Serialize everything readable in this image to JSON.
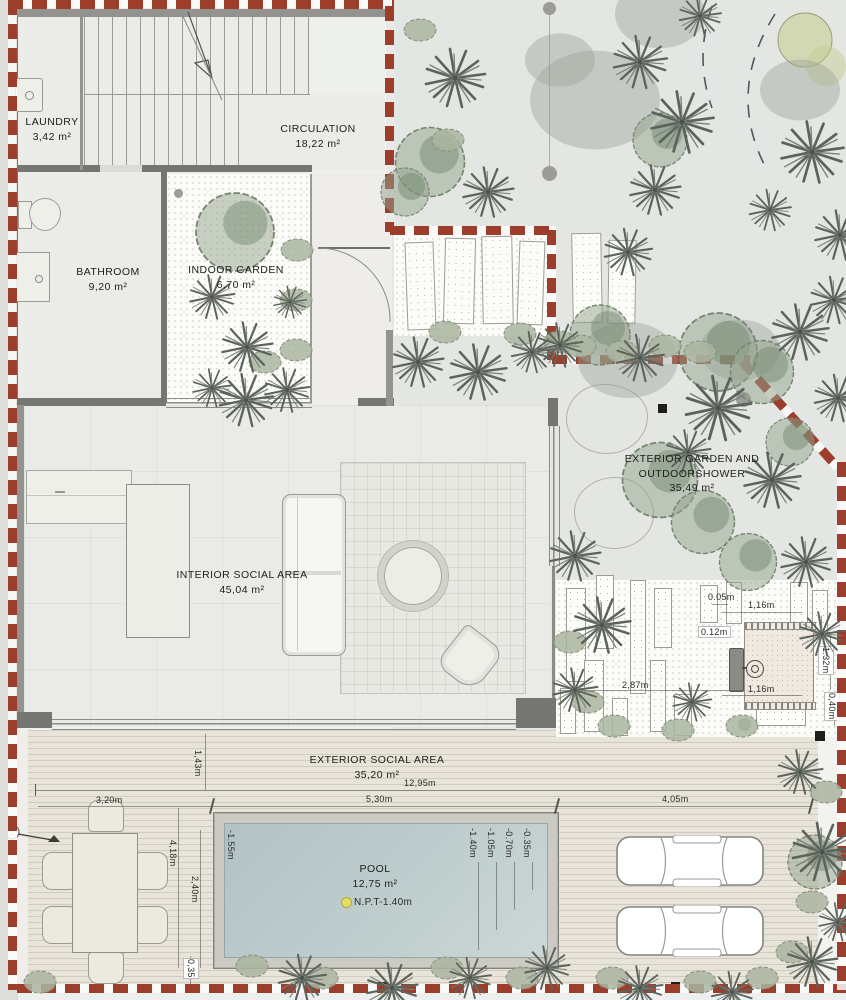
{
  "plan": {
    "rooms": {
      "laundry": {
        "name": "LAUNDRY",
        "area": "3,42 m²"
      },
      "circulation": {
        "name": "CIRCULATION",
        "area": "18,22 m²"
      },
      "bathroom": {
        "name": "BATHROOM",
        "area": "9,20 m²"
      },
      "indoor_garden": {
        "name": "INDOOR GARDEN",
        "area": "6,70 m²"
      },
      "interior_social": {
        "name": "INTERIOR SOCIAL AREA",
        "area": "45,04 m²"
      },
      "exterior_garden": {
        "name_line1": "EXTERIOR GARDEN AND",
        "name_line2": "OUTDOORSHOWER",
        "area": "35,49 m²"
      },
      "exterior_social": {
        "name": "EXTERIOR SOCIAL AREA",
        "area": "35,20 m²"
      },
      "pool": {
        "name": "POOL",
        "area": "12,75 m²",
        "npt_level": "N.P.T-1.40m"
      }
    },
    "dimensions": {
      "overall_width": "12,95m",
      "pool_width": "5,30m",
      "driveway_width": "4,05m",
      "table_zone_width": "3,20m",
      "deck_offset": "1,43m",
      "deck_length": "4,18m",
      "pool_band": "2,40m",
      "edge_strip": "0,35",
      "shower_gap": "0.05m",
      "shower_pad_top": "1,16m",
      "shower_fixture": "0.12m",
      "gravel_width": "2,87m",
      "shower_pad_bottom": "1,16m",
      "shower_pad_height": "1.32m",
      "shower_margin": "0,40m"
    },
    "pool_depths": [
      "-1.55m",
      "-1.40m",
      "-1.05m",
      "-0.70m",
      "-0.35m"
    ],
    "colors": {
      "boundary": "#9d3d2b",
      "water": "#b9c7c9",
      "npt_marker": "#e3dd66"
    }
  }
}
